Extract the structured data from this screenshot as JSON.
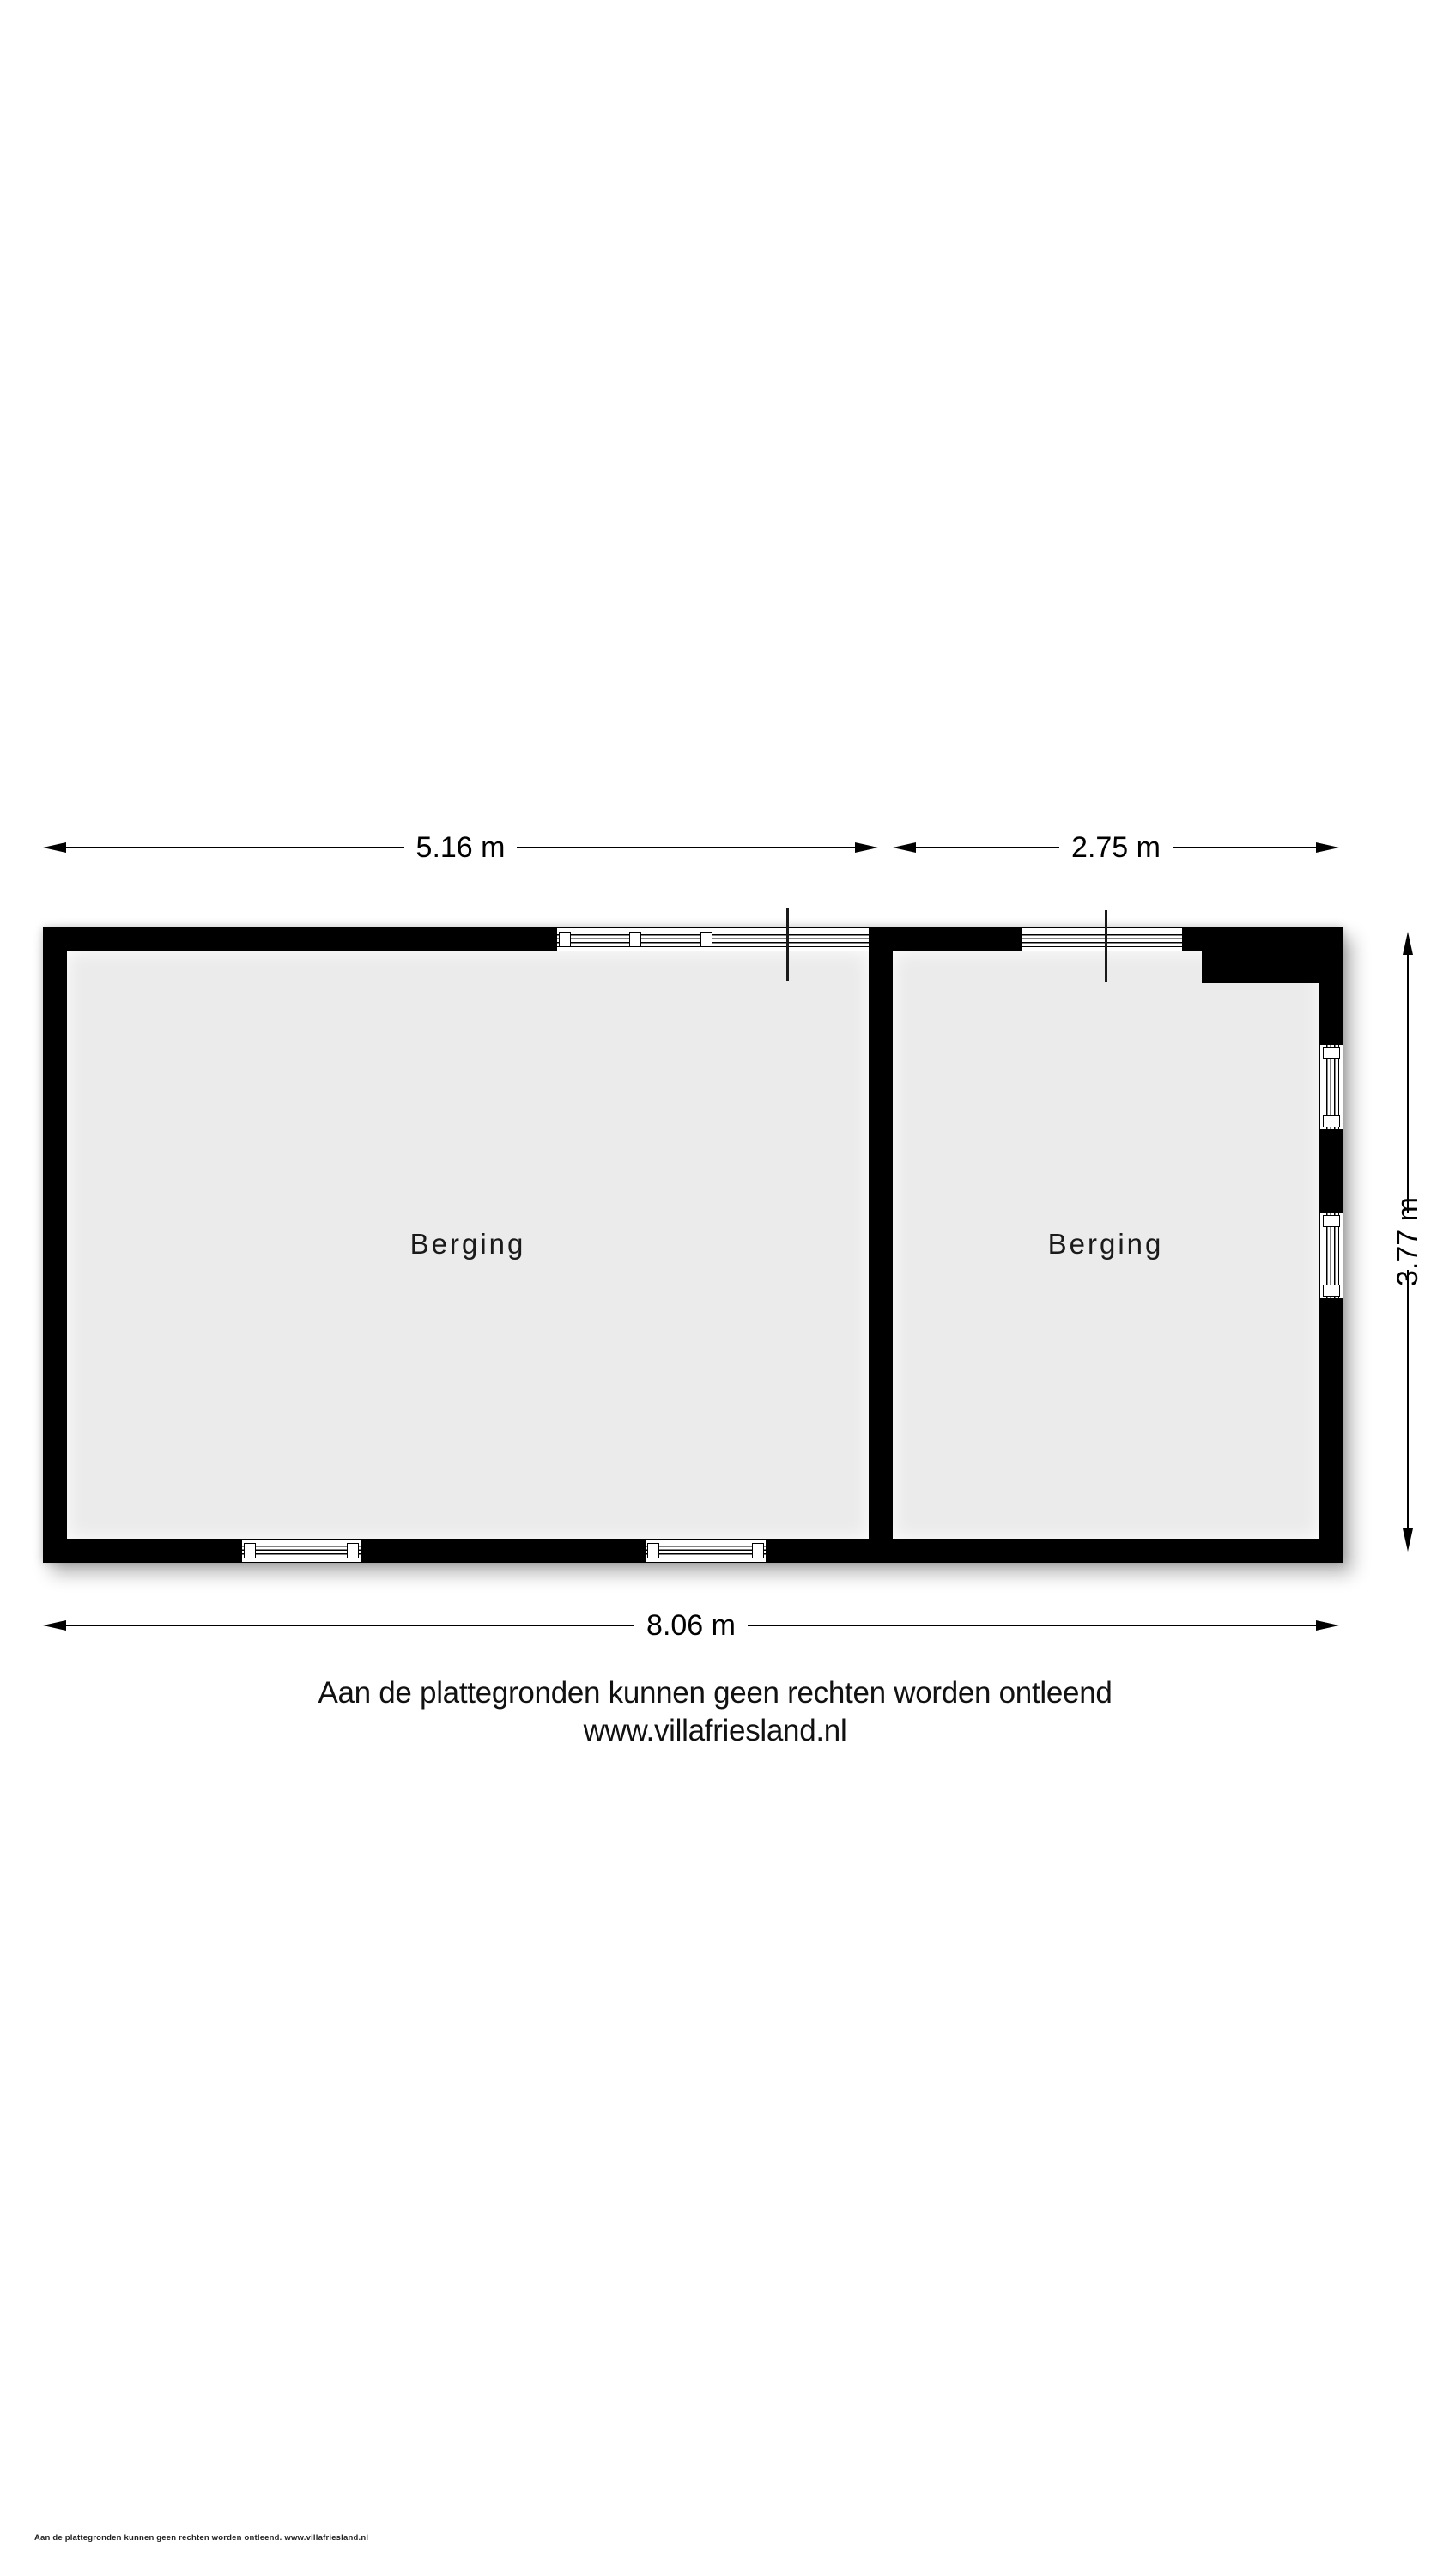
{
  "floorplan": {
    "rooms": [
      {
        "label": "Berging"
      },
      {
        "label": "Berging"
      }
    ],
    "dimensions": {
      "top_left": "5.16 m",
      "top_right": "2.75 m",
      "right_side": "3.77 m",
      "bottom": "8.06 m"
    },
    "disclaimer": {
      "line1": "Aan de plattegronden kunnen geen rechten worden ontleend",
      "line2": "www.villafriesland.nl"
    },
    "footer_small": "Aan de plattegronden kunnen geen rechten worden ontleend. www.villafriesland.nl",
    "colors": {
      "wall": "#000000",
      "room_fill": "#ebebeb",
      "background": "#ffffff"
    }
  }
}
